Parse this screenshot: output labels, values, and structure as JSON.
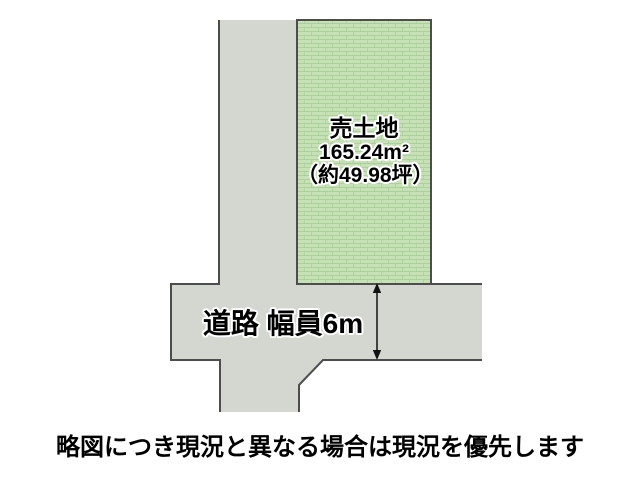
{
  "diagram": {
    "plot": {
      "label": "売土地",
      "area_m2": "165.24m²",
      "area_tsubo": "（約49.98坪）"
    },
    "road": {
      "label": "道路 幅員6m",
      "width_note": "6m"
    },
    "caption": "略図につき現況と異なる場合は現況を優先します"
  },
  "colors": {
    "plot_fill": "#c7e1b7",
    "plot_hatch": "#a9cd99",
    "road_fill": "#d3d7cf",
    "outline": "#4d4d4d",
    "text": "#000000",
    "background": "#ffffff"
  }
}
